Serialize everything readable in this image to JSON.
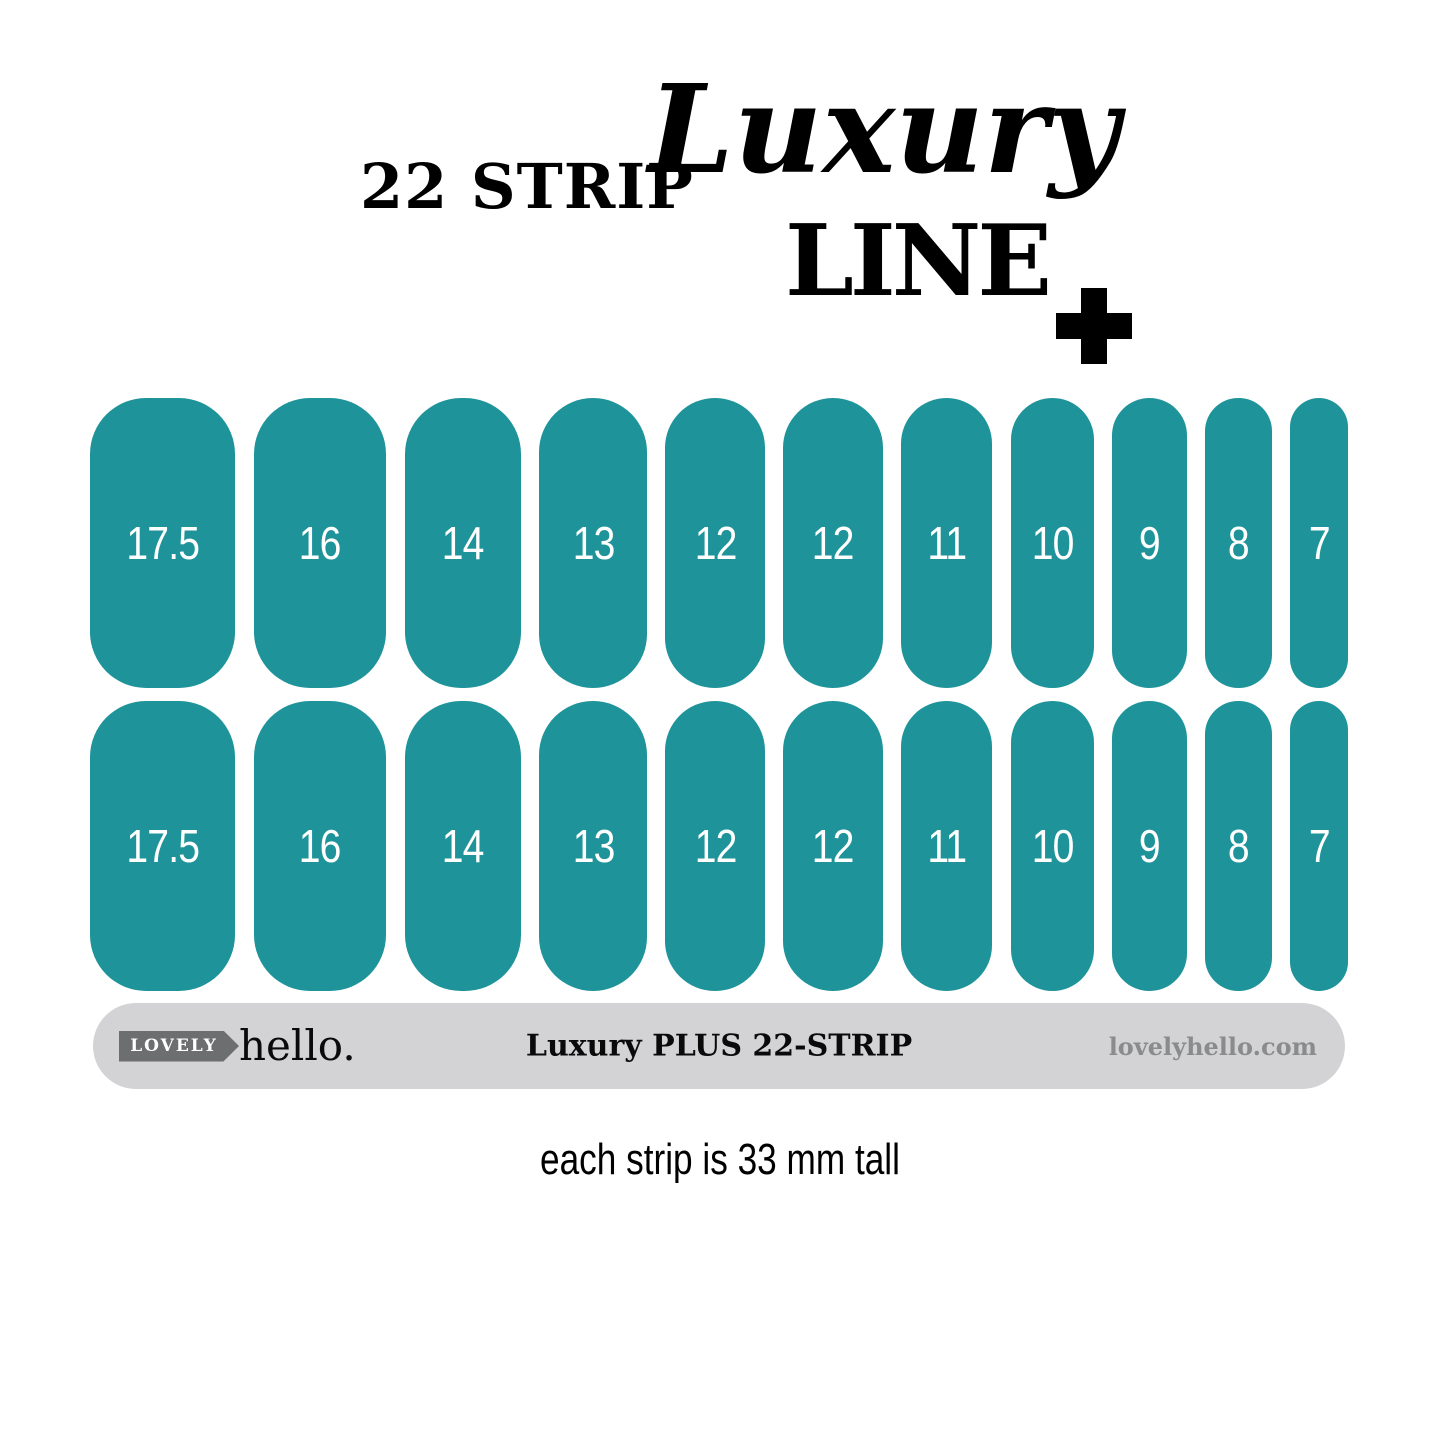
{
  "title": {
    "strip_count_label": "22 STRIP",
    "brand_script": "Luxury",
    "line_label": "LINE",
    "plus_icon": "+"
  },
  "strips": {
    "rows": 2,
    "sizes": [
      "17.5",
      "16",
      "14",
      "13",
      "12",
      "12",
      "11",
      "10",
      "9",
      "8",
      "7"
    ]
  },
  "footer_bar": {
    "logo_badge": "LOVELY",
    "logo_name": "hello.",
    "product_label": "Luxury PLUS 22-STRIP",
    "website": "lovelyhello.com"
  },
  "caption": "each strip is 33 mm tall",
  "colors": {
    "strip": "#1E949A",
    "strip_label": "#FFFFFF",
    "bar": "#D3D3D5",
    "badge": "#6D6E70",
    "website": "#8A8B8D"
  }
}
